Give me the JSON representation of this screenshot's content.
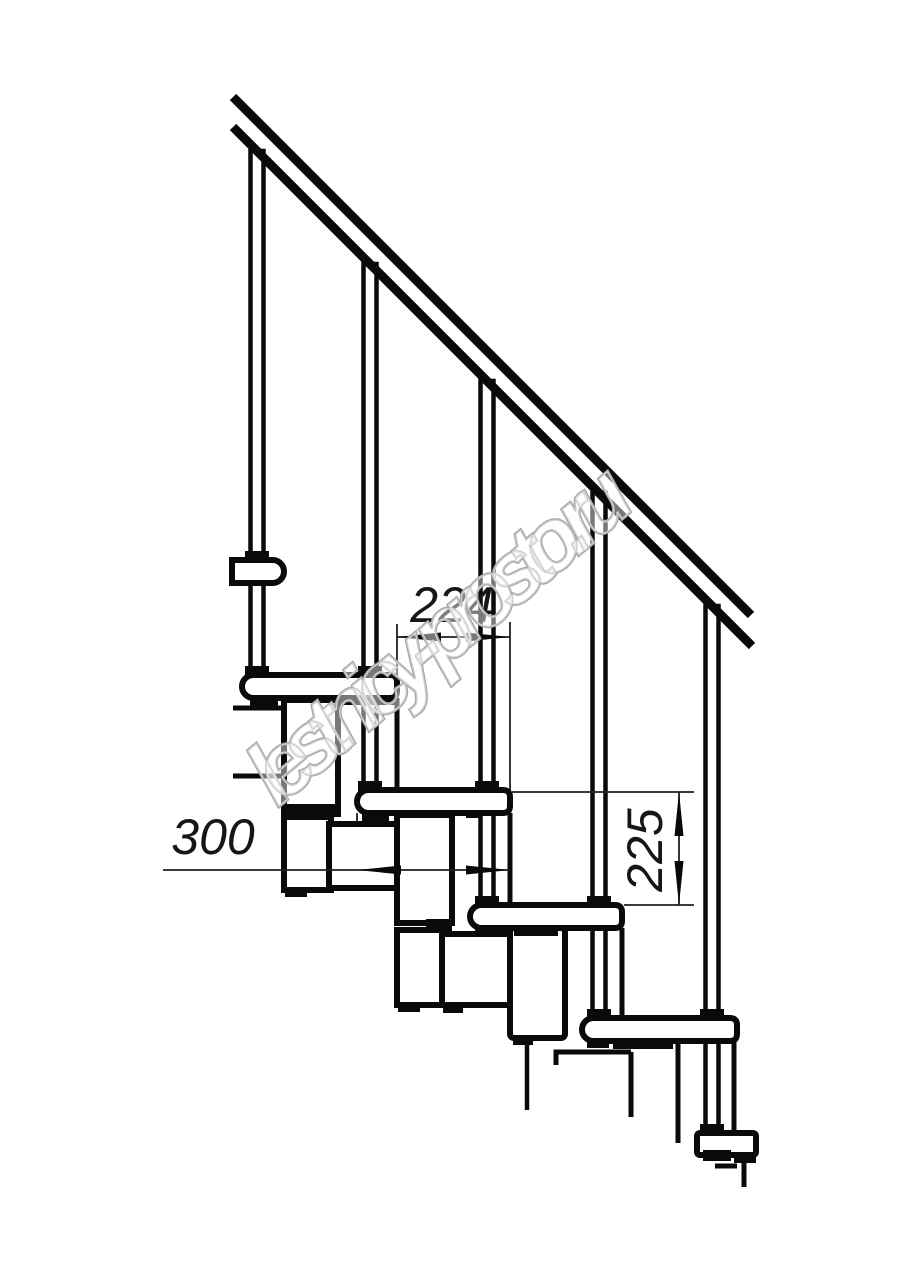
{
  "drawing": {
    "subject": "modular staircase side-view fragment",
    "background_color": "#ffffff",
    "line_color": "#0a0a0a",
    "dimension_line_color": "#1f1f1f",
    "treads_visible": 6,
    "balusters_visible": 5,
    "dimensions": {
      "going": "224",
      "tread_depth": "300",
      "rise": "225"
    }
  },
  "watermark": {
    "text": "lestnicy-prosto.ru",
    "stroke_color": "#a9a9a9"
  }
}
